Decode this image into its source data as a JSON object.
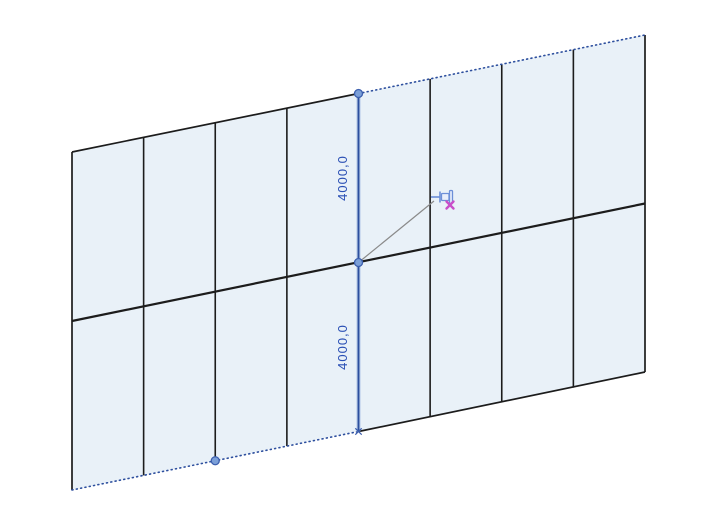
{
  "colors": {
    "background": "#ffffff",
    "panel_fill": "#e9f1f8",
    "grid_line": "#1c1c1c",
    "selection_blue": "#2d4f9e",
    "selection_glow": "#a9c2e6",
    "control_dot_fill": "#7b9fd8",
    "control_dot_ring": "#3c5fae",
    "dimension_text": "#2b50b5",
    "leader_gray": "#8a8a8a",
    "pin_blue": "#6c8fd8",
    "pin_fill": "#e8eefb",
    "pin_x_magenta": "#c94fc9"
  },
  "wall": {
    "columns": 8,
    "rows": 2,
    "corners": {
      "top_left": {
        "x": 72,
        "y": 152
      },
      "top_right": {
        "x": 645,
        "y": 35
      },
      "bottom_right": {
        "x": 645,
        "y": 372
      },
      "bottom_left": {
        "x": 72,
        "y": 490
      }
    },
    "selected_grid_column": 4,
    "control_dots": [
      {
        "x": 358.5,
        "y": 93.5
      },
      {
        "x": 358.5,
        "y": 262.5
      },
      {
        "x": 215.25,
        "y": 460.75
      }
    ],
    "end_mark": {
      "x": 358.5,
      "y": 431.5
    }
  },
  "dimensions": {
    "upper": "4000,0",
    "lower": "4000,0",
    "upper_pos": {
      "x": 347,
      "y": 178
    },
    "lower_pos": {
      "x": 347,
      "y": 347
    }
  },
  "leader": {
    "x1": 358.5,
    "y1": 262.5,
    "x2": 434,
    "y2": 201
  },
  "cursor": {
    "icon": "pin-cursor-icon",
    "x": 431,
    "y": 189
  }
}
